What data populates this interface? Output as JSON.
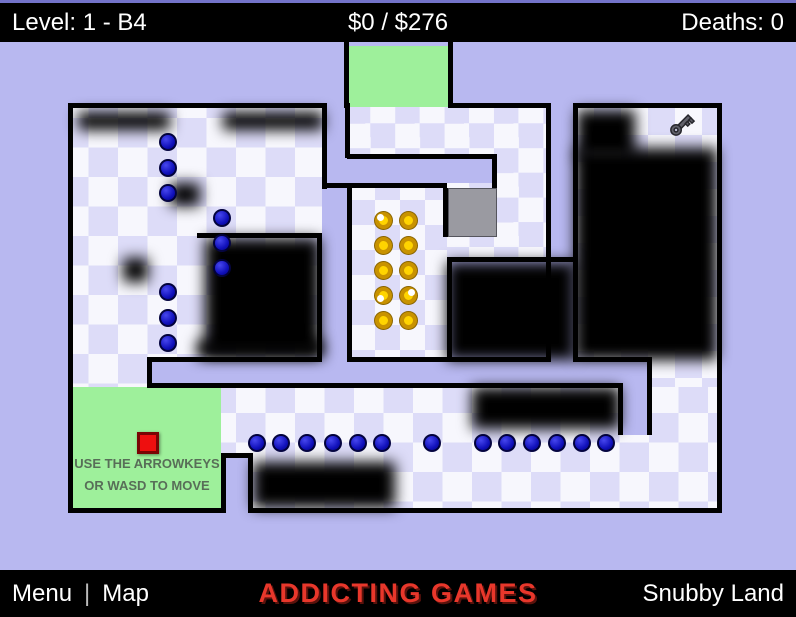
{
  "hud": {
    "level_label": "Level: 1 - B4",
    "money_label": "$0 / $276",
    "deaths_label": "Deaths: 0"
  },
  "footer": {
    "menu_label": "Menu",
    "separator": "|",
    "map_label": "Map",
    "brand": "ADDICTING GAMES",
    "credit": "Snubby Land"
  },
  "start_zone_text": {
    "line1": "USE THE ARROWKEYS",
    "line2": "OR WASD TO MOVE"
  },
  "colors": {
    "bg": "#b8b8f0",
    "ck1": "#f7f7fd",
    "ck2": "#dddcf8",
    "green": "#9ef09b",
    "gray": "#9a9aa1",
    "red": "#ee0f0f",
    "coin-ring": "#c89200",
    "coin-in": "#ffd400",
    "brand-red": "#e8372b"
  },
  "game": {
    "rooms": [
      {
        "x": 73,
        "y": 108,
        "w": 249,
        "h": 279,
        "tile": 29.5
      },
      {
        "x": 221,
        "y": 387,
        "w": 496,
        "h": 121,
        "tile": 29.5
      },
      {
        "x": 349,
        "y": 107,
        "w": 197,
        "h": 155,
        "tile": 24.7
      },
      {
        "x": 351,
        "y": 186,
        "w": 96,
        "h": 171,
        "tile": 25
      },
      {
        "x": 652,
        "y": 362,
        "w": 65,
        "h": 25,
        "tile": 27
      },
      {
        "x": 577,
        "y": 108,
        "w": 140,
        "h": 254,
        "tile": 27
      }
    ],
    "corridors": [
      {
        "x": 152,
        "y": 362,
        "w": 495,
        "h": 21
      },
      {
        "x": 623,
        "y": 383,
        "w": 24,
        "h": 52
      },
      {
        "x": 325,
        "y": 108,
        "w": 22,
        "h": 254
      },
      {
        "x": 349,
        "y": 158,
        "w": 148,
        "h": 25
      },
      {
        "x": 551,
        "y": 108,
        "w": 22,
        "h": 249
      },
      {
        "x": 226,
        "y": 458,
        "w": 22,
        "h": 50
      }
    ],
    "zones": [
      {
        "name": "start-zone",
        "x": 73,
        "y": 387,
        "w": 148,
        "h": 121
      },
      {
        "name": "goal-zone",
        "x": 349,
        "y": 46,
        "w": 99,
        "h": 61
      }
    ],
    "gray_block": {
      "x": 448,
      "y": 188,
      "w": 49,
      "h": 49
    },
    "walls": [
      [
        68,
        103,
        259,
        5
      ],
      [
        68,
        103,
        5,
        410
      ],
      [
        68,
        508,
        158,
        5
      ],
      [
        322,
        103,
        5,
        86
      ],
      [
        344,
        42,
        5,
        66
      ],
      [
        448,
        42,
        5,
        66
      ],
      [
        453,
        103,
        98,
        5
      ],
      [
        546,
        103,
        5,
        259
      ],
      [
        573,
        103,
        5,
        259
      ],
      [
        573,
        103,
        149,
        5
      ],
      [
        717,
        103,
        5,
        259
      ],
      [
        717,
        357,
        5,
        156
      ],
      [
        345,
        103,
        5,
        55
      ],
      [
        347,
        154,
        150,
        5
      ],
      [
        492,
        154,
        5,
        34
      ],
      [
        322,
        183,
        125,
        5
      ],
      [
        443,
        188,
        5,
        49
      ],
      [
        347,
        183,
        5,
        179
      ],
      [
        197,
        233,
        125,
        5
      ],
      [
        317,
        238,
        5,
        124
      ],
      [
        447,
        257,
        126,
        5
      ],
      [
        447,
        262,
        5,
        100
      ],
      [
        147,
        357,
        175,
        5
      ],
      [
        347,
        357,
        204,
        5
      ],
      [
        573,
        357,
        79,
        5
      ],
      [
        147,
        357,
        5,
        31
      ],
      [
        147,
        383,
        476,
        5
      ],
      [
        618,
        388,
        5,
        47
      ],
      [
        647,
        357,
        5,
        78
      ],
      [
        221,
        453,
        32,
        5
      ],
      [
        221,
        458,
        5,
        55
      ],
      [
        248,
        458,
        5,
        50
      ],
      [
        248,
        508,
        474,
        5
      ]
    ],
    "fog": [
      [
        78,
        112,
        92,
        18
      ],
      [
        223,
        112,
        100,
        18
      ],
      [
        170,
        183,
        30,
        23
      ],
      [
        123,
        258,
        25,
        24
      ],
      [
        205,
        238,
        115,
        117
      ],
      [
        577,
        110,
        58,
        48
      ],
      [
        575,
        148,
        142,
        212
      ],
      [
        447,
        262,
        128,
        98
      ],
      [
        472,
        387,
        148,
        42
      ],
      [
        197,
        340,
        126,
        18
      ],
      [
        253,
        462,
        142,
        46
      ]
    ],
    "coins": [
      {
        "x": 383,
        "y": 220,
        "shine": "tl"
      },
      {
        "x": 383,
        "y": 245,
        "shine": null
      },
      {
        "x": 383,
        "y": 270,
        "shine": null
      },
      {
        "x": 383,
        "y": 295,
        "shine": "bl"
      },
      {
        "x": 383,
        "y": 320,
        "shine": null
      },
      {
        "x": 408,
        "y": 220,
        "shine": null
      },
      {
        "x": 408,
        "y": 245,
        "shine": null
      },
      {
        "x": 408,
        "y": 270,
        "shine": null
      },
      {
        "x": 408,
        "y": 295,
        "shine": "tr"
      },
      {
        "x": 408,
        "y": 320,
        "shine": null
      }
    ],
    "enemies": [
      {
        "x": 170,
        "y": 144
      },
      {
        "x": 170,
        "y": 170
      },
      {
        "x": 170,
        "y": 195
      },
      {
        "x": 224,
        "y": 220
      },
      {
        "x": 224,
        "y": 245
      },
      {
        "x": 224,
        "y": 270
      },
      {
        "x": 170,
        "y": 294
      },
      {
        "x": 170,
        "y": 320
      },
      {
        "x": 170,
        "y": 345
      },
      {
        "x": 259,
        "y": 445
      },
      {
        "x": 283,
        "y": 445
      },
      {
        "x": 309,
        "y": 445
      },
      {
        "x": 335,
        "y": 445
      },
      {
        "x": 360,
        "y": 445
      },
      {
        "x": 384,
        "y": 445
      },
      {
        "x": 434,
        "y": 445
      },
      {
        "x": 485,
        "y": 445
      },
      {
        "x": 509,
        "y": 445
      },
      {
        "x": 534,
        "y": 445
      },
      {
        "x": 559,
        "y": 445
      },
      {
        "x": 584,
        "y": 445
      },
      {
        "x": 608,
        "y": 445
      }
    ],
    "player": {
      "x": 137,
      "y": 432
    },
    "key": {
      "x": 666,
      "y": 110
    }
  }
}
